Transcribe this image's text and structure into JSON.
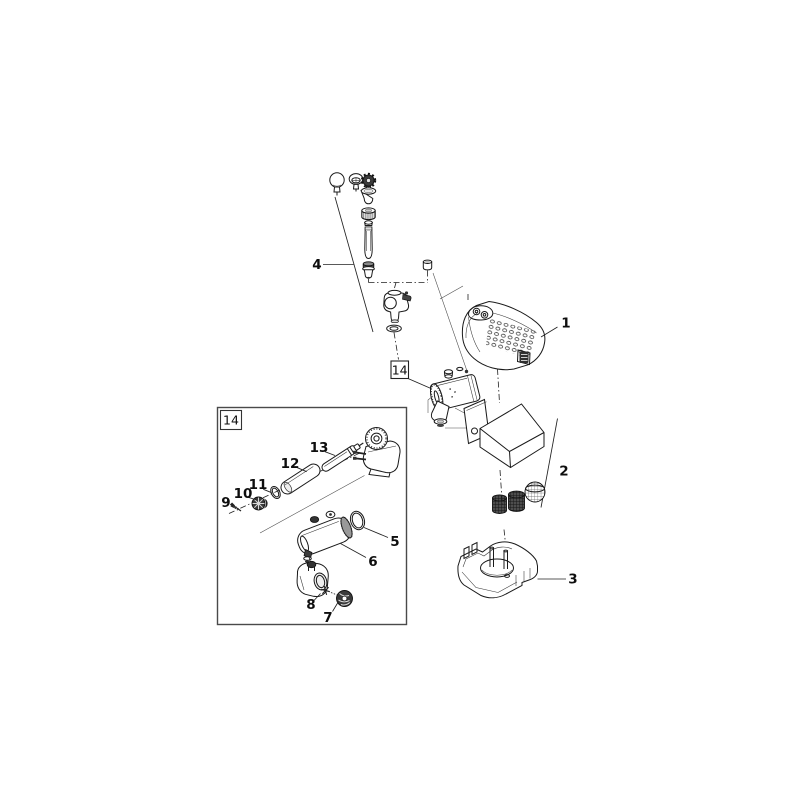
{
  "diagram": {
    "background_color": "#ffffff",
    "line_color": "#1a1a1a",
    "callouts": {
      "c1": "1",
      "c2": "2",
      "c3": "3",
      "c4": "4",
      "c5": "5",
      "c6": "6",
      "c7": "7",
      "c8": "8",
      "c9": "9",
      "c10": "10",
      "c11": "11",
      "c12": "12",
      "c13": "13"
    },
    "reference_boxes": {
      "main": "14",
      "detail": "14"
    }
  }
}
